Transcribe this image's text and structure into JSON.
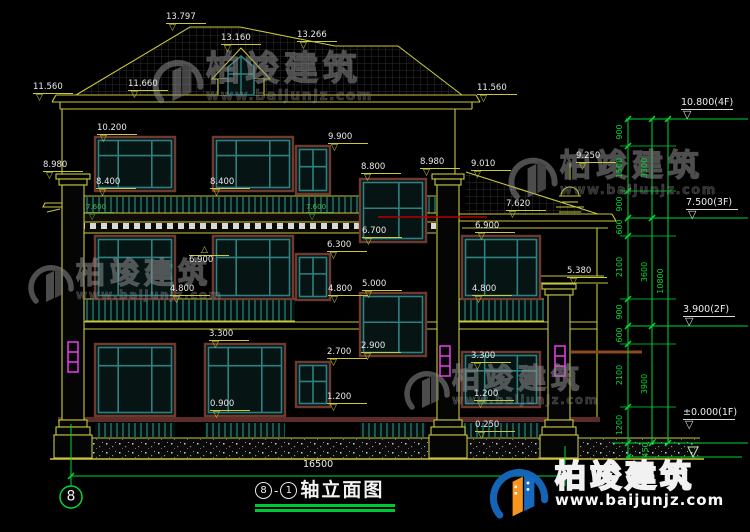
{
  "drawing": {
    "axis_bubble": "8",
    "total_width_dim": "16500",
    "title_ref_a": "8",
    "title_sep": "-",
    "title_ref_b": "1",
    "title_text": "轴立面图"
  },
  "watermark": {
    "brand": "柏竣建筑",
    "url": "www.baijunjz.com"
  },
  "colors": {
    "background": "#000000",
    "linework_yellow": "#c9c93e",
    "window_teal": "#2f8080",
    "window_frame_maroon": "#70392e",
    "dimension_green": "#00d935",
    "text_white": "#e9e9e9",
    "downspout_magenta": "#e93ee9",
    "accent_red_line": "#b30000",
    "logo_blue": "#1465b8",
    "logo_orange": "#f7941d",
    "title_underline_green": "#00c832"
  },
  "elevation_flags": [
    {
      "v": "13.797",
      "x": 166,
      "y": 13
    },
    {
      "v": "13.160",
      "x": 221,
      "y": 34
    },
    {
      "v": "13.266",
      "x": 297,
      "y": 31
    },
    {
      "v": "11.560",
      "x": 33,
      "y": 83
    },
    {
      "v": "11.660",
      "x": 128,
      "y": 80
    },
    {
      "v": "11.560",
      "x": 477,
      "y": 84
    },
    {
      "v": "10.200",
      "x": 97,
      "y": 124
    },
    {
      "v": "9.900",
      "x": 328,
      "y": 133
    },
    {
      "v": "8.980",
      "x": 43,
      "y": 161
    },
    {
      "v": "8.400",
      "x": 96,
      "y": 178
    },
    {
      "v": "8.400",
      "x": 210,
      "y": 178
    },
    {
      "v": "8.800",
      "x": 361,
      "y": 163
    },
    {
      "v": "8.980",
      "x": 420,
      "y": 158
    },
    {
      "v": "9.010",
      "x": 471,
      "y": 160
    },
    {
      "v": "9.250",
      "x": 576,
      "y": 152
    },
    {
      "v": "7.620",
      "x": 506,
      "y": 200
    },
    {
      "v": "6.900",
      "x": 475,
      "y": 222
    },
    {
      "v": "6.700",
      "x": 362,
      "y": 227
    },
    {
      "v": "6.300",
      "x": 327,
      "y": 241
    },
    {
      "v": "6.900",
      "x": 189,
      "y": 246,
      "up": true
    },
    {
      "v": "7.600",
      "x": 86,
      "y": 204,
      "g": true
    },
    {
      "v": "7.600",
      "x": 306,
      "y": 204,
      "g": true
    },
    {
      "v": "5.380",
      "x": 567,
      "y": 267
    },
    {
      "v": "4.800",
      "x": 170,
      "y": 285
    },
    {
      "v": "4.800",
      "x": 328,
      "y": 285
    },
    {
      "v": "5.000",
      "x": 362,
      "y": 280
    },
    {
      "v": "4.800",
      "x": 472,
      "y": 285
    },
    {
      "v": "3.300",
      "x": 209,
      "y": 330
    },
    {
      "v": "2.700",
      "x": 327,
      "y": 348
    },
    {
      "v": "2.900",
      "x": 361,
      "y": 342
    },
    {
      "v": "3.300",
      "x": 471,
      "y": 352
    },
    {
      "v": "1.200",
      "x": 327,
      "y": 393
    },
    {
      "v": "0.900",
      "x": 210,
      "y": 400
    },
    {
      "v": "1.200",
      "x": 474,
      "y": 390
    },
    {
      "v": "0.250",
      "x": 475,
      "y": 421
    }
  ],
  "story_levels": [
    {
      "label": "10.800(4F)",
      "x": 681,
      "y": 98
    },
    {
      "label": "7.500(3F)",
      "x": 686,
      "y": 198
    },
    {
      "label": "3.900(2F)",
      "x": 683,
      "y": 305
    },
    {
      "label": "±0.000(1F)",
      "x": 683,
      "y": 408
    }
  ],
  "vertical_dims": {
    "segments": [
      {
        "v": "900",
        "x": 620,
        "y": 132
      },
      {
        "v": "1500",
        "x": 620,
        "y": 168
      },
      {
        "v": "900",
        "x": 620,
        "y": 204
      },
      {
        "v": "600",
        "x": 620,
        "y": 227
      },
      {
        "v": "2100",
        "x": 620,
        "y": 267
      },
      {
        "v": "900",
        "x": 620,
        "y": 312
      },
      {
        "v": "600",
        "x": 620,
        "y": 335
      },
      {
        "v": "2100",
        "x": 620,
        "y": 375
      },
      {
        "v": "1200",
        "x": 620,
        "y": 425
      },
      {
        "v": "450",
        "x": 646,
        "y": 450
      }
    ],
    "groups": [
      {
        "v": "3300",
        "x": 645,
        "y": 168
      },
      {
        "v": "3600",
        "x": 645,
        "y": 272
      },
      {
        "v": "3900",
        "x": 645,
        "y": 384
      }
    ],
    "total": [
      {
        "v": "10800",
        "x": 661,
        "y": 281
      }
    ]
  },
  "watermark_instances": [
    {
      "x": 150,
      "y": 52,
      "brand_size": 34,
      "url_size": 14,
      "logo": 56
    },
    {
      "x": 26,
      "y": 258,
      "brand_size": 29,
      "url_size": 12,
      "logo": 50
    },
    {
      "x": 506,
      "y": 150,
      "brand_size": 31,
      "url_size": 13,
      "logo": 54
    },
    {
      "x": 402,
      "y": 364,
      "brand_size": 28,
      "url_size": 12,
      "logo": 50
    }
  ]
}
